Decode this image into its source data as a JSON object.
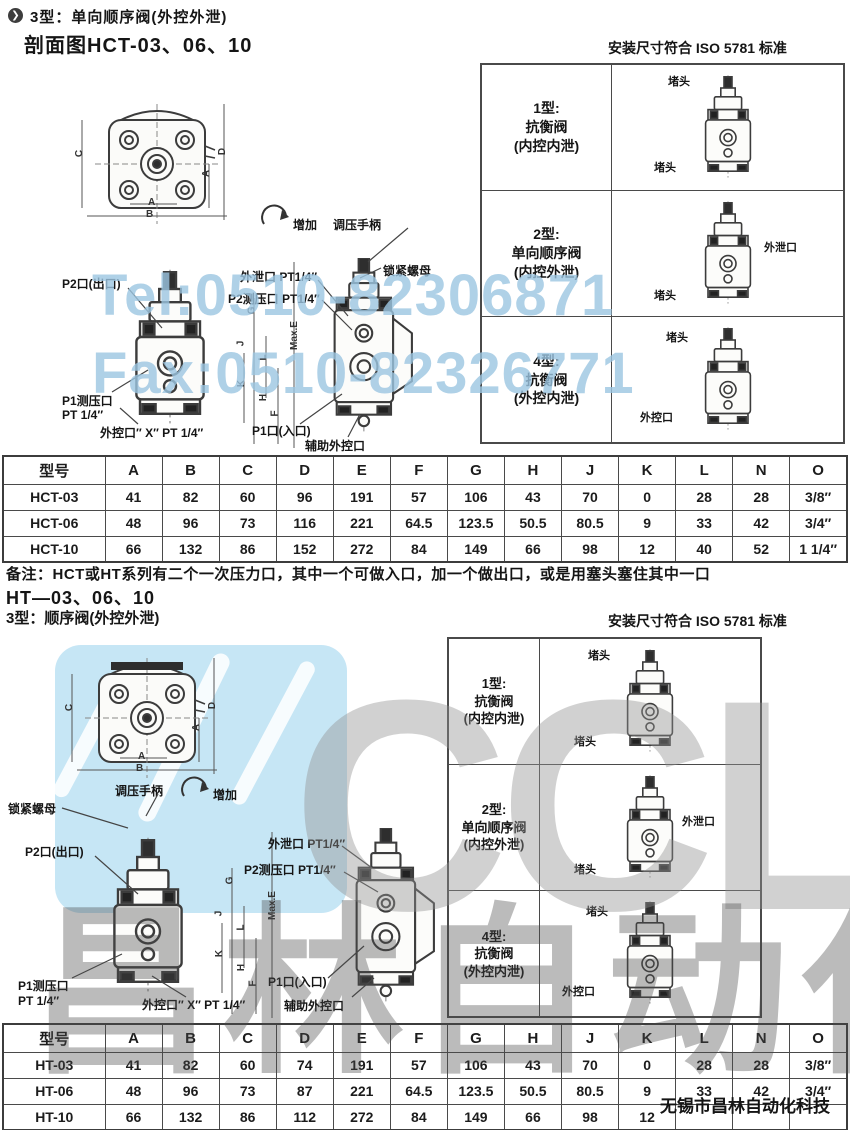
{
  "header": {
    "bullet": "❯",
    "title": "3型：单向顺序阀(外控外泄)"
  },
  "section1": {
    "title": "剖面图HCT-03、06、10",
    "standard": "安装尺寸符合 ISO 5781 标准",
    "labels": {
      "increase": "增加",
      "handle": "调压手柄",
      "lock_nut": "锁紧螺母",
      "p2_out": "P2口(出口)",
      "drain_port": "外泄口 PT1/4″",
      "p2_gauge": "P2测压口 PT1/4″",
      "p1_gauge_1": "P1测压口",
      "p1_gauge_2": "PT 1/4″",
      "ext_ctrl": "外控口″ X″ PT 1/4″",
      "p1_in": "P1口(入口)",
      "aux_ctrl": "辅助外控口",
      "max_e": "Max.E",
      "dims": {
        "a": "A",
        "b": "B",
        "c": "C",
        "d": "D",
        "g": "G",
        "j": "J",
        "l": "L",
        "k": "K",
        "h": "H",
        "f": "F"
      }
    },
    "panel": {
      "rows": [
        {
          "line1": "1型:",
          "line2": "抗衡阀",
          "line3": "(内控内泄)",
          "callout_a": "堵头",
          "callout_b": "堵头"
        },
        {
          "line1": "2型:",
          "line2": "单向顺序阀",
          "line3": "(内控外泄)",
          "callout_a": "外泄口",
          "callout_b": "堵头"
        },
        {
          "line1": "4型:",
          "line2": "抗衡阀",
          "line3": "(外控内泄)",
          "callout_a": "堵头",
          "callout_b": "外控口"
        }
      ]
    },
    "table": {
      "headers": [
        "型号",
        "A",
        "B",
        "C",
        "D",
        "E",
        "F",
        "G",
        "H",
        "J",
        "K",
        "L",
        "N",
        "O"
      ],
      "rows": [
        [
          "HCT-03",
          "41",
          "82",
          "60",
          "96",
          "191",
          "57",
          "106",
          "43",
          "70",
          "0",
          "28",
          "28",
          "3/8″"
        ],
        [
          "HCT-06",
          "48",
          "96",
          "73",
          "116",
          "221",
          "64.5",
          "123.5",
          "50.5",
          "80.5",
          "9",
          "33",
          "42",
          "3/4″"
        ],
        [
          "HCT-10",
          "66",
          "132",
          "86",
          "152",
          "272",
          "84",
          "149",
          "66",
          "98",
          "12",
          "40",
          "52",
          "1 1/4″"
        ]
      ]
    }
  },
  "note": "备注：HCT或HT系列有二个一次压力口，其中一个可做入口，加一个做出口，或是用塞头塞住其中一口",
  "section2": {
    "series_title": "HT—03、06、10",
    "title": "3型：顺序阀(外控外泄)",
    "standard": "安装尺寸符合 ISO 5781 标准",
    "labels": {
      "increase": "增加",
      "handle": "调压手柄",
      "lock_nut": "锁紧螺母",
      "p2_out": "P2口(出口)",
      "drain_port": "外泄口 PT1/4″",
      "p2_gauge": "P2测压口 PT1/4″",
      "p1_gauge_1": "P1测压口",
      "p1_gauge_2": "PT 1/4″",
      "ext_ctrl": "外控口″ X″ PT 1/4″",
      "p1_in": "P1口(入口)",
      "aux_ctrl": "辅助外控口",
      "max_e": "Max.E",
      "dims": {
        "a": "A",
        "b": "B",
        "c": "C",
        "d": "D",
        "g": "G",
        "j": "J",
        "l": "L",
        "k": "K",
        "h": "H",
        "f": "F"
      }
    },
    "panel": {
      "rows": [
        {
          "line1": "1型:",
          "line2": "抗衡阀",
          "line3": "(内控内泄)",
          "callout_a": "堵头",
          "callout_b": "堵头"
        },
        {
          "line1": "2型:",
          "line2": "单向顺序阀",
          "line3": "(内控外泄)",
          "callout_a": "外泄口",
          "callout_b": "堵头"
        },
        {
          "line1": "4型:",
          "line2": "抗衡阀",
          "line3": "(外控内泄)",
          "callout_a": "堵头",
          "callout_b": "外控口"
        }
      ]
    },
    "table": {
      "headers": [
        "型号",
        "A",
        "B",
        "C",
        "D",
        "E",
        "F",
        "G",
        "H",
        "J",
        "K",
        "L",
        "N",
        "O"
      ],
      "rows": [
        [
          "HT-03",
          "41",
          "82",
          "60",
          "74",
          "191",
          "57",
          "106",
          "43",
          "70",
          "0",
          "28",
          "28",
          "3/8″"
        ],
        [
          "HT-06",
          "48",
          "96",
          "73",
          "87",
          "221",
          "64.5",
          "123.5",
          "50.5",
          "80.5",
          "9",
          "33",
          "42",
          "3/4″"
        ],
        [
          "HT-10",
          "66",
          "132",
          "86",
          "112",
          "272",
          "84",
          "149",
          "66",
          "98",
          "12",
          "",
          "",
          ""
        ]
      ]
    }
  },
  "watermarks": {
    "tel": "Tel:0510-82306871",
    "fax": "Fax:0510-82326771",
    "brand": "CCLair",
    "cn": "昌林自动化",
    "blue": "#9cc6e2",
    "gray": "#919191"
  },
  "footer": {
    "company": "无锡市昌林自动化科技"
  }
}
